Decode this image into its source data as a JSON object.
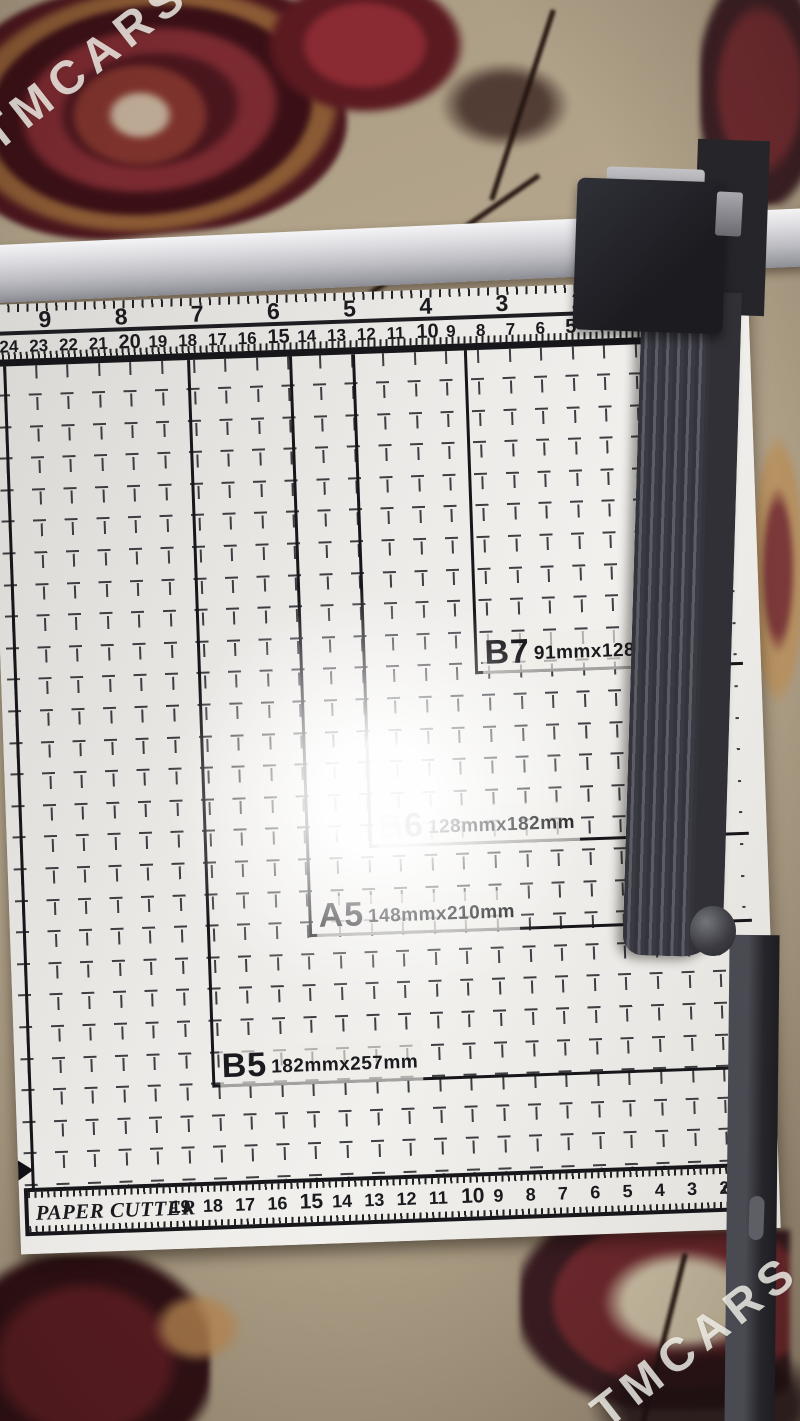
{
  "watermark": {
    "text": "TMCARS"
  },
  "board": {
    "inch_numbers": [
      "9",
      "8",
      "7",
      "6",
      "5",
      "4",
      "3",
      "2"
    ],
    "cm_numbers": [
      "24",
      "23",
      "22",
      "21",
      "20",
      "19",
      "18",
      "17",
      "16",
      "15",
      "14",
      "13",
      "12",
      "11",
      "10",
      "9",
      "8",
      "7",
      "6",
      "5",
      "4"
    ],
    "size_marks": [
      {
        "label": "B7",
        "dims": "91mmx128mm"
      },
      {
        "label": "B6",
        "dims": "128mmx182mm"
      },
      {
        "label": "A5",
        "dims": "148mmx210mm"
      },
      {
        "label": "B5",
        "dims": "182mmx257mm"
      }
    ],
    "bottom_ruler": {
      "brand": "PAPER CUTTER",
      "numbers": [
        "19",
        "18",
        "17",
        "16",
        "15",
        "14",
        "13",
        "12",
        "11",
        "10",
        "9",
        "8",
        "7",
        "6",
        "5",
        "4",
        "3",
        "2"
      ],
      "unit": "cm"
    }
  },
  "colors": {
    "board": "#eceae7",
    "lines": "#17171b",
    "metal_bar": "#c9c9cf",
    "handle": "#3a3a42",
    "carpet_base": "#b0a189",
    "carpet_red": "#5a1c22"
  }
}
